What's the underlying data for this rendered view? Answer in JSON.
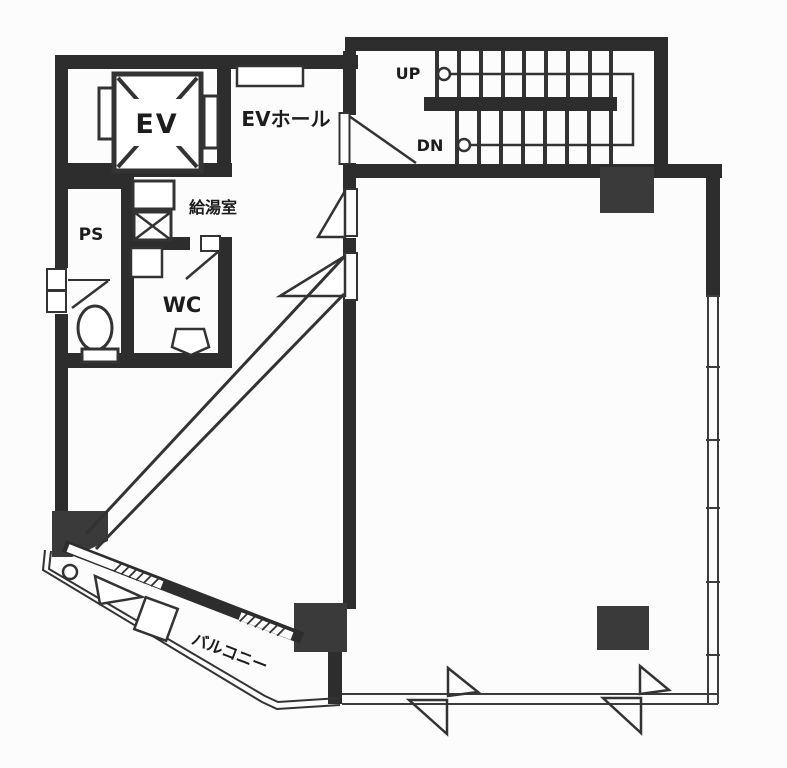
{
  "plan": {
    "type": "floor-plan",
    "labels": {
      "ev": "EV",
      "ev_hall": "EVホール",
      "kitchenette": "給湯室",
      "pipe_space": "PS",
      "wc": "WC",
      "balcony": "バルコニー",
      "up": "UP",
      "down": "DN"
    },
    "colors": {
      "wall": "#2d2d2d",
      "column": "#3a3a3a",
      "line": "#333333",
      "background": "#fcfcfc"
    }
  }
}
